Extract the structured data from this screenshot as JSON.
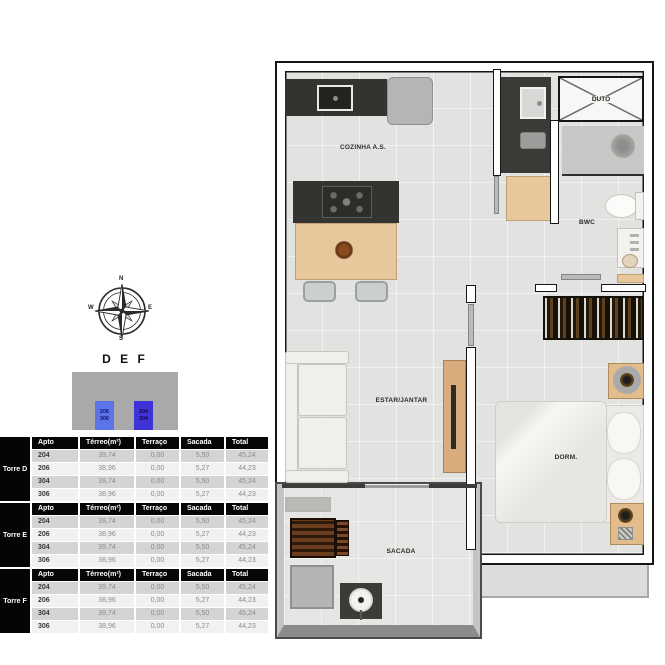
{
  "compass": {
    "n": "N",
    "s": "S",
    "e": "E",
    "w": "W"
  },
  "key": {
    "title": "D E F",
    "light_units": "206\n306",
    "dark_units": "204\n304",
    "colors": {
      "light_unit_fill": "#5b74e8",
      "dark_unit_fill": "#3d33d6",
      "block_fill": "#a9a9a9"
    }
  },
  "tables": [
    {
      "tower": "Torre D",
      "headers": [
        "Apto",
        "Térreo(m²)",
        "Terraço",
        "Sacada",
        "Total"
      ],
      "rows": [
        [
          "204",
          "39,74",
          "0,00",
          "5,50",
          "45,24"
        ],
        [
          "206",
          "38,96",
          "0,00",
          "5,27",
          "44,23"
        ],
        [
          "304",
          "39,74",
          "0,00",
          "5,50",
          "45,24"
        ],
        [
          "306",
          "38,96",
          "0,00",
          "5,27",
          "44,23"
        ]
      ]
    },
    {
      "tower": "Torre E",
      "headers": [
        "Apto",
        "Térreo(m²)",
        "Terraço",
        "Sacada",
        "Total"
      ],
      "rows": [
        [
          "204",
          "39,74",
          "0,00",
          "5,50",
          "45,24"
        ],
        [
          "206",
          "38,96",
          "0,00",
          "5,27",
          "44,23"
        ],
        [
          "304",
          "39,74",
          "0,00",
          "5,50",
          "45,24"
        ],
        [
          "306",
          "38,96",
          "0,00",
          "5,27",
          "44,23"
        ]
      ]
    },
    {
      "tower": "Torre F",
      "headers": [
        "Apto",
        "Térreo(m²)",
        "Terraço",
        "Sacada",
        "Total"
      ],
      "rows": [
        [
          "204",
          "39,74",
          "0,00",
          "5,50",
          "45,24"
        ],
        [
          "206",
          "38,96",
          "0,00",
          "5,27",
          "44,23"
        ],
        [
          "304",
          "39,74",
          "0,00",
          "5,50",
          "45,24"
        ],
        [
          "306",
          "38,96",
          "0,00",
          "5,27",
          "44,23"
        ]
      ]
    }
  ],
  "floorplan": {
    "labels": {
      "cozinha": "COZINHA A.S.",
      "duto": "DUTO",
      "bwc": "BWC",
      "estar": "ESTAR/JANTAR",
      "dorm": "DORM.",
      "sacada": "SACADA"
    }
  }
}
